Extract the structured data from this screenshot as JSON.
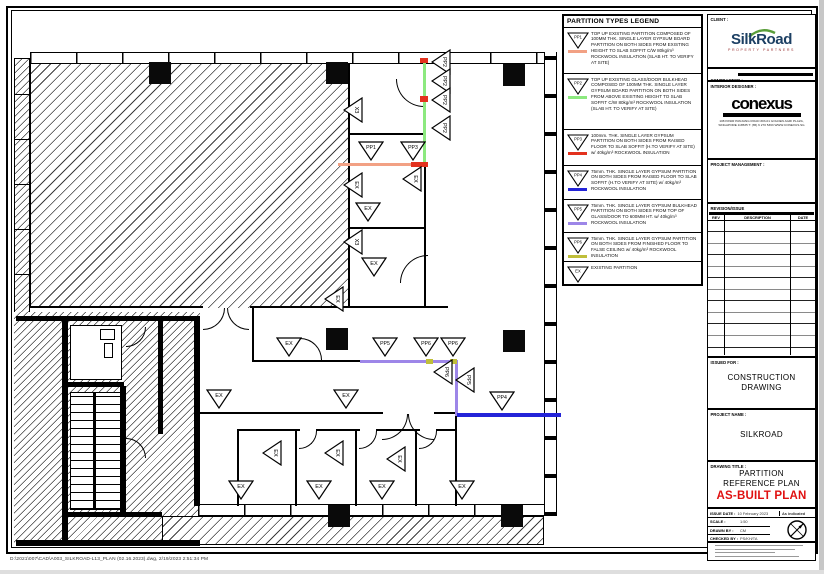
{
  "page": {
    "footer_path": "D:\\2021\\007\\CAD\\A003_SILKROAD-L13_PLAN (02.16.2023).dwg, 2/19/2023 2:51:34 PM"
  },
  "legend": {
    "title": "PARTITION TYPES LEGEND",
    "items": [
      {
        "code": "PP1",
        "color": "#F2A184",
        "height": 45,
        "desc": "TOP UP EXISTING PARTITION COMPOSED OF 100MM THK. SINGLE LAYER GYPSUM BOARD PARTITION ON BOTH SIDES FROM EXISTING HEIGHT TO SLAB SOFFIT C/W 80kg/m³ ROCKWOOL INSULATION  (SLAB HT. TO VERIFY AT SITE)"
      },
      {
        "code": "PP2",
        "color": "#8CE97F",
        "height": 55,
        "desc": "TOP UP EXISTING GLASS/DOOR BULKHEAD COMPOSED OF 100MM THK. SINGLE LAYER GYPSUM BOARD PARTITION ON BOTH SIDES FROM ABOVE EXISTING HEIGHT TO SLAB SOFFIT C/W 80kg/m³ ROCKWOOL INSULATION  (SLAB HT. TO VERIFY AT SITE)"
      },
      {
        "code": "PP3",
        "color": "#E3321E",
        "height": 35,
        "desc": "100mm. THK. SINGLE LAYER GYPSUM PARTITION ON BOTH SIDES FROM RAISED FLOOR TO SLAB SOFFIT (H.TO VERIFY AT SITE) w/ 40kg/m³ ROCKWOOL INSULATION"
      },
      {
        "code": "PP4",
        "color": "#2424D8",
        "height": 33,
        "desc": "75mm. THK. SINGLE LAYER GYPSUM PARTITION ON BOTH SIDES FROM RAISED FLOOR TO SLAB SOFFIT (H.TO VERIFY AT SITE) w/ 40kg/m³ ROCKWOOL INSULATION"
      },
      {
        "code": "PP5",
        "color": "#9D86E8",
        "height": 32,
        "desc": "75mm. THK. SINGLE LAYER GYPSUM BULKHEAD PARTITION ON BOTH SIDES FROM TOP OF GLASS/DOOR TO 600MM HT.  w/ 40kg/m³ ROCKWOOL INSULATION"
      },
      {
        "code": "PP6",
        "color": "#BFBE3A",
        "height": 28,
        "desc": "75mm. THK. SINGLE LAYER GYPSUM PARTITION ON BOTH SIDES FROM FINISHED FLOOR TO FALSE CEILING  w/ 40kg/m³ ROCKWOOL INSULATION"
      },
      {
        "code": "EX",
        "color": null,
        "height": 22,
        "desc": "EXISTING PARTITION"
      }
    ]
  },
  "titleblock": {
    "client_label": "CLIENT :",
    "client_name": "SilkRoad",
    "client_sub": "PROPERTY PARTNERS",
    "contractor_label": "CONTRACTOR :",
    "designer_label": "INTERIOR DESIGNER :",
    "designer_name": "conexus",
    "designer_address1": "108 PASIR PANJANG ROAD #03-01 GOLDEN AGRI PLAZA,",
    "designer_address2": "SINGAPORE 118535  T: (65) 6 270 5363   WWW.CONEXUS.SG",
    "pm_label": "PROJECT MANAGEMENT :",
    "revision_label": "REVISION/ISSUE",
    "rev_cols": [
      "REV",
      "DESCRIPTION",
      "DATE"
    ],
    "empty_row_count": 13,
    "issued_for_label": "ISSUED FOR :",
    "issued_for_line1": "CONSTRUCTION",
    "issued_for_line2": "DRAWING",
    "project_label": "PROJECT NAME :",
    "project_name": "SILKROAD",
    "title_label": "DRAWING TITLE :",
    "drawing_title_line1": "PARTITION",
    "drawing_title_line2": "REFERENCE PLAN",
    "plan_status": "AS-BUILT PLAN",
    "status_color": "#E01010",
    "issue_date_label": "ISSUE DATE :",
    "issue_date": "10 February 2023",
    "corner_note": "As indicated",
    "scale_label": "SCALE :",
    "scale": "1:50",
    "drawn_label": "DRAWN BY :",
    "drawn": "CM",
    "checked_label": "CHECKED BY :",
    "checked": "PS/KH/TA"
  },
  "plan": {
    "markers": [
      {
        "x": 358,
        "y": 141,
        "label": "PP1",
        "rot": 0
      },
      {
        "x": 400,
        "y": 141,
        "label": "PP3",
        "rot": 0
      },
      {
        "x": 355,
        "y": 202,
        "label": "EX",
        "rot": 0
      },
      {
        "x": 361,
        "y": 257,
        "label": "EX",
        "rot": 0
      },
      {
        "x": 276,
        "y": 337,
        "label": "EX",
        "rot": 0
      },
      {
        "x": 206,
        "y": 389,
        "label": "EX",
        "rot": 0
      },
      {
        "x": 333,
        "y": 389,
        "label": "EX",
        "rot": 0
      },
      {
        "x": 372,
        "y": 337,
        "label": "PP5",
        "rot": 0
      },
      {
        "x": 413,
        "y": 337,
        "label": "PP6",
        "rot": 0
      },
      {
        "x": 440,
        "y": 337,
        "label": "PP6",
        "rot": 0
      },
      {
        "x": 489,
        "y": 391,
        "label": "PP4",
        "rot": 0
      },
      {
        "x": 228,
        "y": 480,
        "label": "EX",
        "rot": 0
      },
      {
        "x": 306,
        "y": 480,
        "label": "EX",
        "rot": 0
      },
      {
        "x": 369,
        "y": 480,
        "label": "EX",
        "rot": 0
      },
      {
        "x": 449,
        "y": 480,
        "label": "EX",
        "rot": 0
      },
      {
        "x": 340,
        "y": 100,
        "label": "X3",
        "rot": 90
      },
      {
        "x": 340,
        "y": 175,
        "label": "EX",
        "rot": 90
      },
      {
        "x": 399,
        "y": 169,
        "label": "EX",
        "rot": 90
      },
      {
        "x": 340,
        "y": 232,
        "label": "X3",
        "rot": 90
      },
      {
        "x": 321,
        "y": 289,
        "label": "EX",
        "rot": 90
      },
      {
        "x": 428,
        "y": 52,
        "label": "PP2",
        "rot": 90
      },
      {
        "x": 428,
        "y": 71,
        "label": "PP2",
        "rot": 90
      },
      {
        "x": 428,
        "y": 90,
        "label": "PP2",
        "rot": 90
      },
      {
        "x": 428,
        "y": 118,
        "label": "PP2",
        "rot": 90
      },
      {
        "x": 430,
        "y": 362,
        "label": "PP6",
        "rot": 90
      },
      {
        "x": 452,
        "y": 370,
        "label": "PP5",
        "rot": 90
      },
      {
        "x": 259,
        "y": 443,
        "label": "EX",
        "rot": 90
      },
      {
        "x": 321,
        "y": 443,
        "label": "EX",
        "rot": 90
      },
      {
        "x": 383,
        "y": 449,
        "label": "EX",
        "rot": 90
      }
    ],
    "columns": [
      {
        "x": 149,
        "y": 62
      },
      {
        "x": 326,
        "y": 62
      },
      {
        "x": 503,
        "y": 64
      },
      {
        "x": 326,
        "y": 328
      },
      {
        "x": 503,
        "y": 330
      },
      {
        "x": 328,
        "y": 505
      },
      {
        "x": 501,
        "y": 505
      }
    ],
    "partitions": [
      {
        "id": "pp1-line",
        "x": 338,
        "y": 163,
        "w": 88,
        "h": 3,
        "color": "#F2A184"
      },
      {
        "id": "pp2-line",
        "x": 423,
        "y": 58,
        "w": 3,
        "h": 108,
        "color": "#8CE97F"
      },
      {
        "id": "pp3-seg1",
        "x": 420,
        "y": 58,
        "w": 8,
        "h": 5,
        "color": "#E3321E"
      },
      {
        "id": "pp3-seg2",
        "x": 420,
        "y": 96,
        "w": 8,
        "h": 6,
        "color": "#E3321E"
      },
      {
        "id": "pp3-seg3",
        "x": 411,
        "y": 162,
        "w": 17,
        "h": 5,
        "color": "#E3321E"
      },
      {
        "id": "pp5-line-h",
        "x": 360,
        "y": 360,
        "w": 98,
        "h": 3,
        "color": "#9D86E8"
      },
      {
        "id": "pp5-line-v",
        "x": 455,
        "y": 360,
        "w": 3,
        "h": 56,
        "color": "#9D86E8"
      },
      {
        "id": "pp6-seg1",
        "x": 426,
        "y": 359,
        "w": 7,
        "h": 5,
        "color": "#BFBE3A"
      },
      {
        "id": "pp6-seg2",
        "x": 450,
        "y": 359,
        "w": 7,
        "h": 5,
        "color": "#BFBE3A"
      },
      {
        "id": "pp4-line",
        "x": 457,
        "y": 413,
        "w": 104,
        "h": 4,
        "color": "#2424D8"
      }
    ]
  }
}
